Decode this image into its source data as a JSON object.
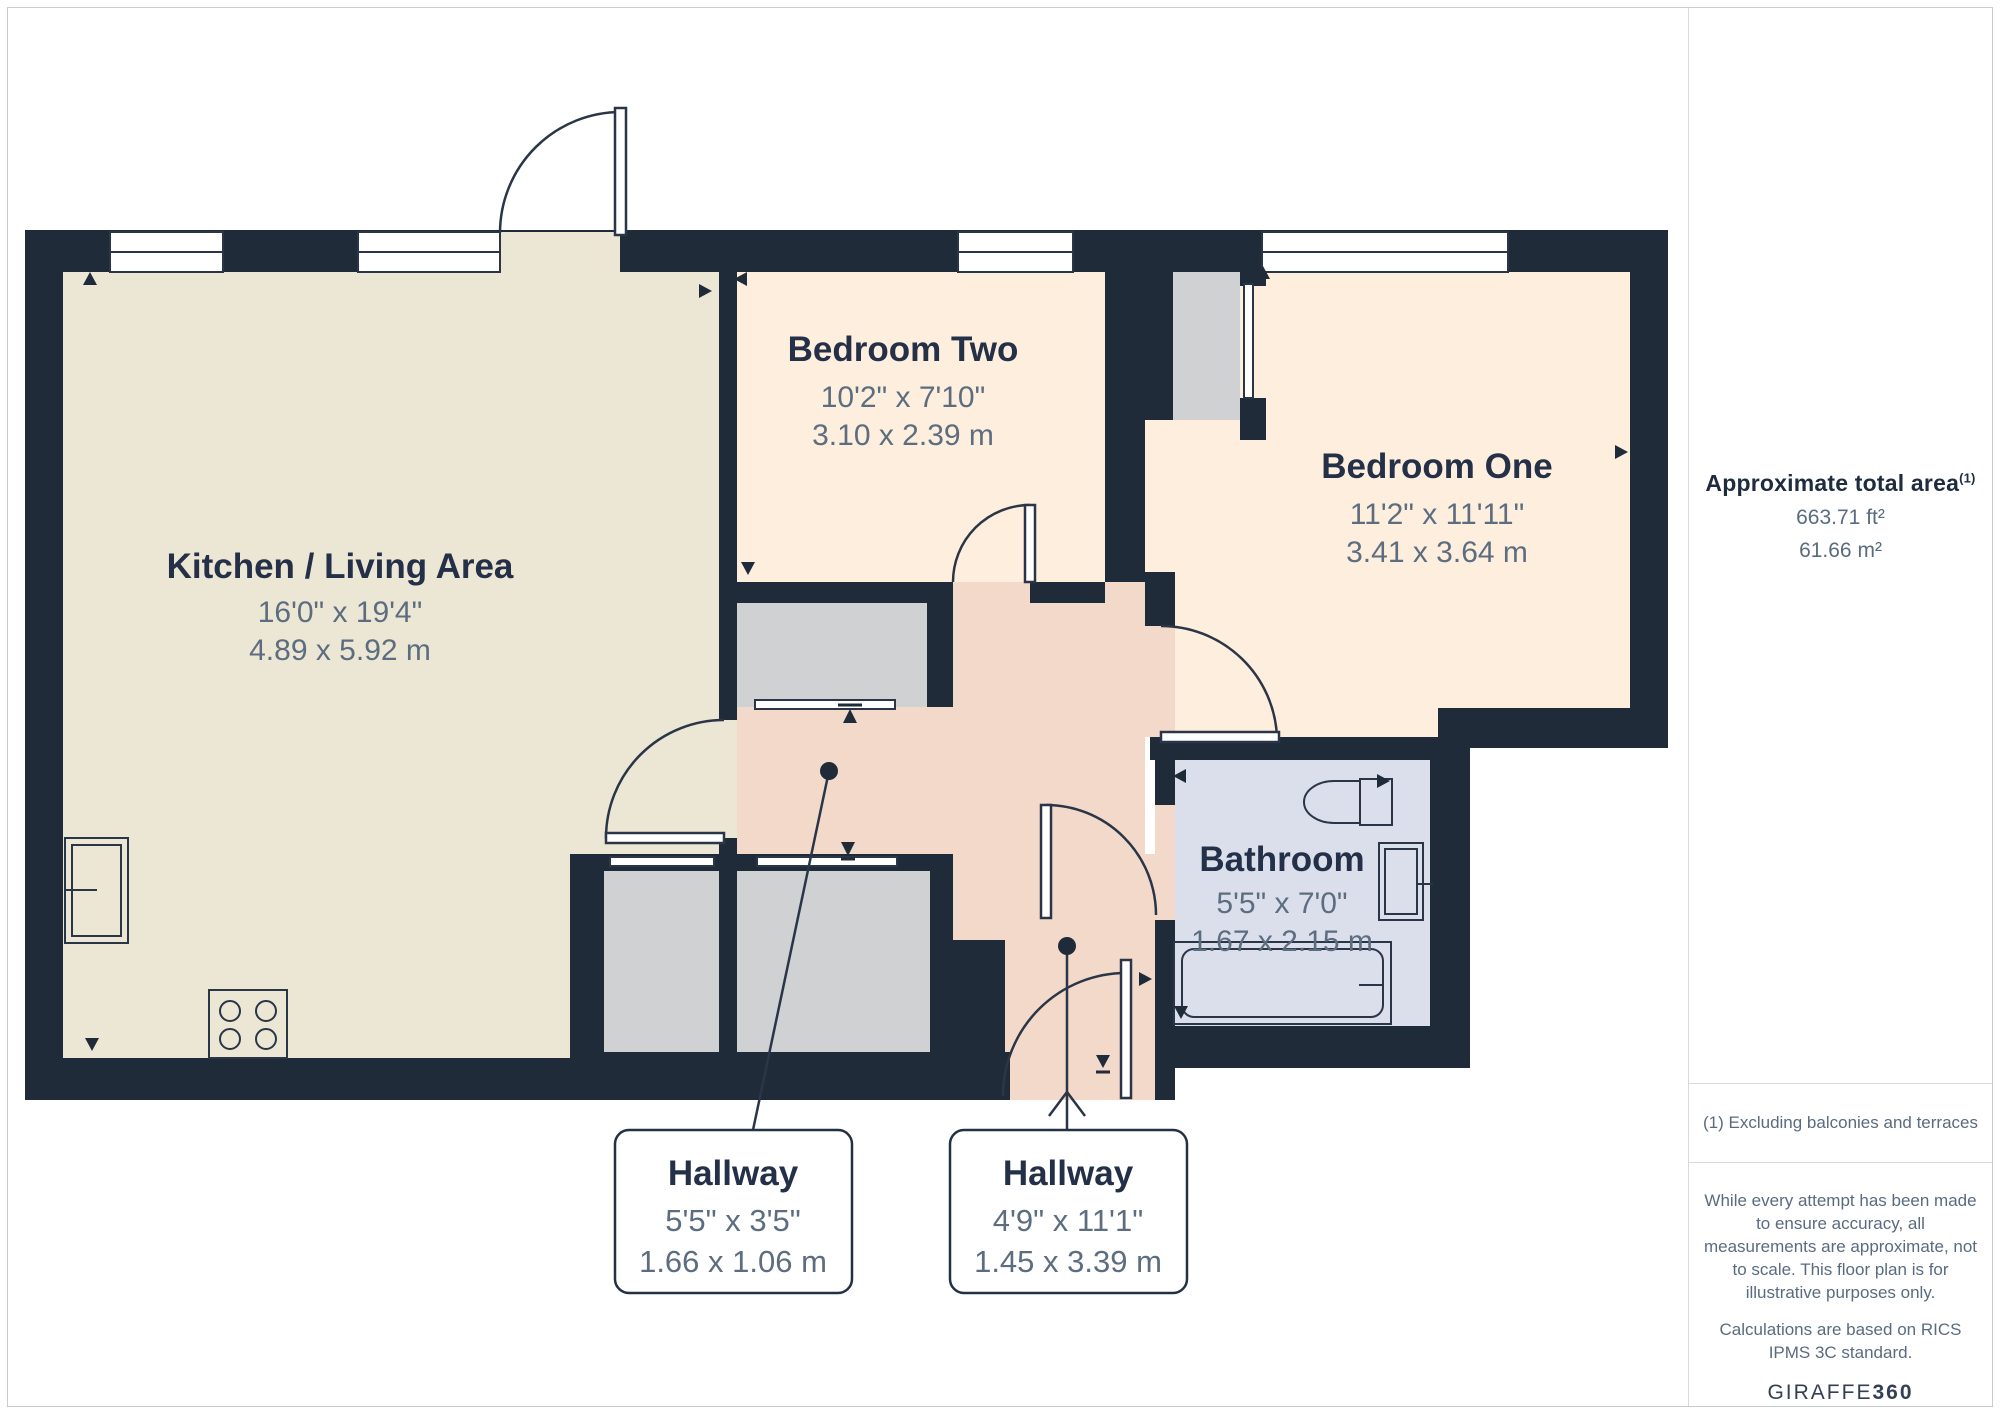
{
  "plan": {
    "colors": {
      "wall": "#202b3a",
      "kitchen_floor": "#ece6d4",
      "bedroom_floor": "#fdeedd",
      "hallway_floor": "#f3d9c9",
      "bathroom_floor": "#dbdfec",
      "closet_floor": "#cfd1d3",
      "line": "#2a3648"
    },
    "rooms": [
      {
        "name": "Kitchen / Living Area",
        "imperial": "16'0\" x 19'4\"",
        "metric": "4.89 x 5.92 m"
      },
      {
        "name": "Bedroom Two",
        "imperial": "10'2\" x 7'10\"",
        "metric": "3.10 x 2.39 m"
      },
      {
        "name": "Bedroom One",
        "imperial": "11'2\" x 11'11\"",
        "metric": "3.41 x 3.64 m"
      },
      {
        "name": "Bathroom",
        "imperial": "5'5\" x 7'0\"",
        "metric": "1.67 x 2.15 m"
      },
      {
        "name": "Hallway",
        "imperial": "5'5\" x 3'5\"",
        "metric": "1.66 x 1.06 m"
      },
      {
        "name": "Hallway",
        "imperial": "4'9\" x 11'1\"",
        "metric": "1.45 x 3.39 m"
      }
    ]
  },
  "sidebar": {
    "area_title": "Approximate total area",
    "area_footnote_marker": "(1)",
    "area_imperial": "663.71 ft²",
    "area_metric": "61.66 m²",
    "footnote": "(1) Excluding balconies and terraces",
    "disclaimer": "While every attempt has been made to ensure accuracy, all measurements are approximate, not to scale. This floor plan is for illustrative purposes only.",
    "standard_note": "Calculations are based on RICS IPMS 3C standard.",
    "brand_name": "GIRAFFE",
    "brand_suffix": "360"
  }
}
